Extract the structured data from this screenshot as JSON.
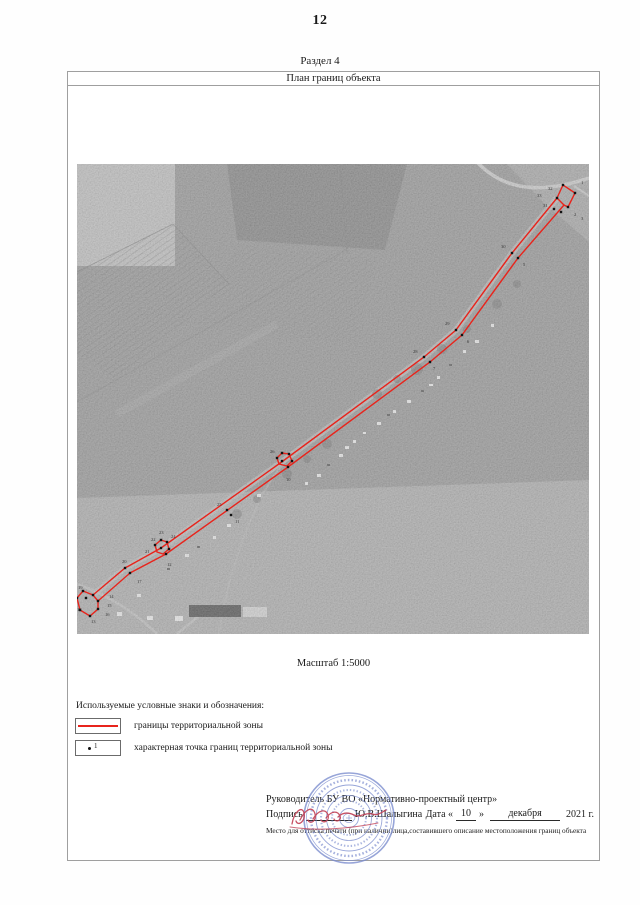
{
  "page": {
    "number": "12",
    "section_label": "Раздел 4",
    "plan_title": "План границ объекта",
    "scale_label": "Масштаб 1:5000"
  },
  "colors": {
    "boundary": "#e8241c",
    "point": "#121212",
    "map_label": "#2b2b2b",
    "seal": "#7b8cce",
    "signature": "#c24055"
  },
  "legend": {
    "heading": "Используемые условные знаки и обозначения:",
    "items": [
      {
        "symbol": "boundary-line-sample",
        "label": "границы территориальной зоны"
      },
      {
        "symbol": "point-sample",
        "point_label": "1",
        "label": "характерная точка границ территориальной зоны"
      }
    ]
  },
  "signature_block": {
    "role_line": "Руководитель БУ ВО «Нормативно-проектный центр»",
    "sign_label": "Подпись",
    "name": "Ю.В.Шалыгина",
    "date_label": "Дата «",
    "date_day": "10",
    "date_quote_close": "»",
    "date_month": "декабря",
    "date_year": "2021 г.",
    "stamp_note": "Место для оттиска печати (при наличии)лица,составившего описание местоположения границ объекта"
  },
  "map": {
    "lines": [
      [
        [
          480,
          34
        ],
        [
          435,
          89
        ],
        [
          379,
          166
        ],
        [
          347,
          193
        ],
        [
          206,
          297
        ],
        [
          84,
          384
        ],
        [
          48,
          404
        ],
        [
          16,
          431
        ]
      ],
      [
        [
          487,
          41
        ],
        [
          441,
          94
        ],
        [
          385,
          171
        ],
        [
          353,
          198
        ],
        [
          211,
          303
        ],
        [
          89,
          390
        ],
        [
          53,
          409
        ],
        [
          21,
          437
        ]
      ]
    ],
    "loops": [
      [
        [
          480,
          34
        ],
        [
          486,
          21
        ],
        [
          498,
          29
        ],
        [
          491,
          43
        ],
        [
          487,
          41
        ]
      ],
      [
        [
          202,
          300
        ],
        [
          200,
          294
        ],
        [
          205,
          289
        ],
        [
          212,
          290
        ],
        [
          215,
          297
        ],
        [
          210,
          302
        ]
      ],
      [
        [
          80,
          388
        ],
        [
          78,
          381
        ],
        [
          84,
          376
        ],
        [
          90,
          378
        ],
        [
          92,
          385
        ],
        [
          86,
          390
        ]
      ],
      [
        [
          16,
          431
        ],
        [
          6,
          427
        ],
        [
          0,
          434
        ],
        [
          3,
          446
        ],
        [
          13,
          452
        ],
        [
          21,
          445
        ],
        [
          21,
          437
        ]
      ]
    ],
    "dots": [
      [
        486,
        21
      ],
      [
        498,
        29
      ],
      [
        491,
        43
      ],
      [
        480,
        34
      ],
      [
        477,
        45
      ],
      [
        484,
        48
      ],
      [
        435,
        89
      ],
      [
        441,
        94
      ],
      [
        379,
        166
      ],
      [
        385,
        171
      ],
      [
        347,
        193
      ],
      [
        353,
        198
      ],
      [
        200,
        294
      ],
      [
        205,
        289
      ],
      [
        212,
        290
      ],
      [
        215,
        297
      ],
      [
        205,
        297
      ],
      [
        211,
        303
      ],
      [
        150,
        346
      ],
      [
        154,
        351
      ],
      [
        78,
        381
      ],
      [
        84,
        376
      ],
      [
        90,
        378
      ],
      [
        92,
        385
      ],
      [
        84,
        384
      ],
      [
        89,
        390
      ],
      [
        48,
        404
      ],
      [
        53,
        409
      ],
      [
        16,
        431
      ],
      [
        21,
        437
      ],
      [
        6,
        427
      ],
      [
        0,
        434
      ],
      [
        3,
        446
      ],
      [
        13,
        452
      ],
      [
        21,
        445
      ],
      [
        9,
        434
      ]
    ],
    "point_labels": [
      {
        "t": "1",
        "x": 504,
        "y": 20
      },
      {
        "t": "2",
        "x": 497,
        "y": 52
      },
      {
        "t": "3",
        "x": 504,
        "y": 56
      },
      {
        "t": "32",
        "x": 471,
        "y": 26
      },
      {
        "t": "33",
        "x": 460,
        "y": 33
      },
      {
        "t": "31",
        "x": 466,
        "y": 43
      },
      {
        "t": "30",
        "x": 424,
        "y": 84
      },
      {
        "t": "5",
        "x": 446,
        "y": 102
      },
      {
        "t": "29",
        "x": 368,
        "y": 161
      },
      {
        "t": "6",
        "x": 390,
        "y": 179
      },
      {
        "t": "28",
        "x": 336,
        "y": 189
      },
      {
        "t": "7",
        "x": 356,
        "y": 206
      },
      {
        "t": "26",
        "x": 193,
        "y": 289
      },
      {
        "t": "10",
        "x": 209,
        "y": 317
      },
      {
        "t": "25",
        "x": 140,
        "y": 342
      },
      {
        "t": "11",
        "x": 158,
        "y": 359
      },
      {
        "t": "24",
        "x": 94,
        "y": 374
      },
      {
        "t": "23",
        "x": 82,
        "y": 370
      },
      {
        "t": "22",
        "x": 74,
        "y": 377
      },
      {
        "t": "21",
        "x": 68,
        "y": 389
      },
      {
        "t": "20",
        "x": 45,
        "y": 399
      },
      {
        "t": "12",
        "x": 90,
        "y": 402
      },
      {
        "t": "17",
        "x": 60,
        "y": 419
      },
      {
        "t": "19",
        "x": 1,
        "y": 425
      },
      {
        "t": "14",
        "x": 32,
        "y": 434
      },
      {
        "t": "15",
        "x": 30,
        "y": 443
      },
      {
        "t": "16",
        "x": 28,
        "y": 452
      },
      {
        "t": "18",
        "x": 0,
        "y": 447
      },
      {
        "t": "13",
        "x": 14,
        "y": 459
      }
    ]
  }
}
